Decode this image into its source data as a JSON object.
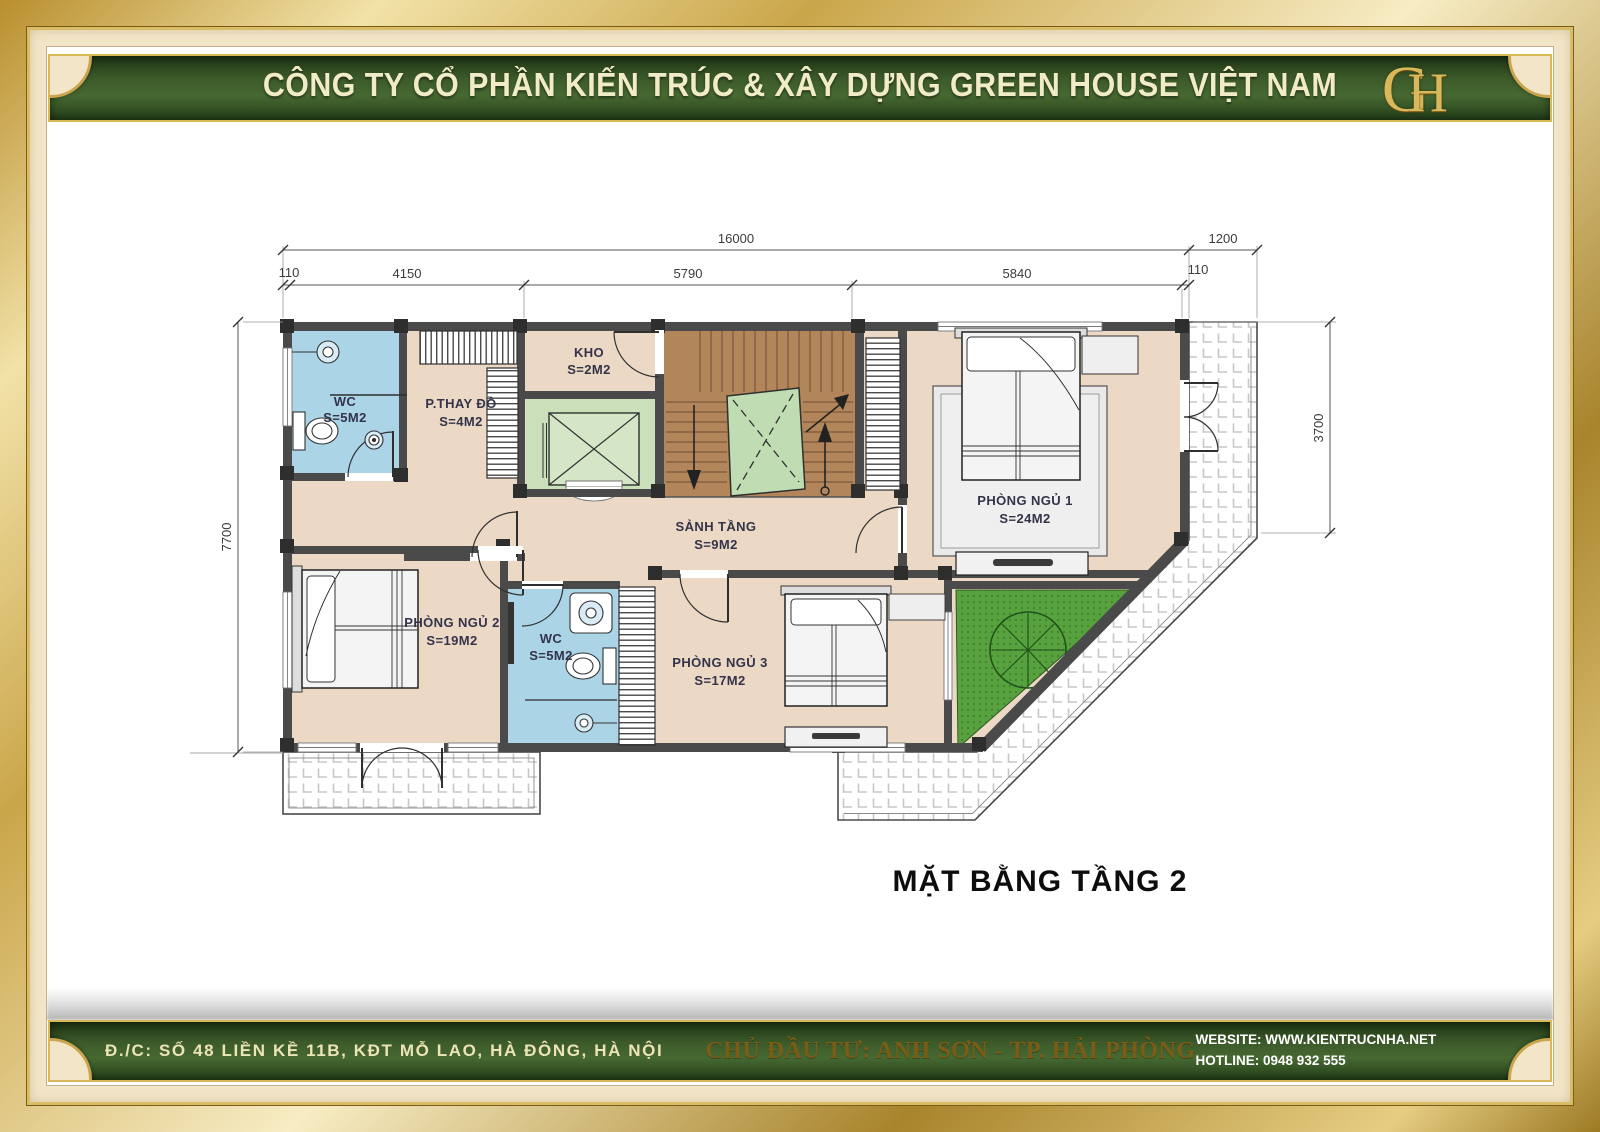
{
  "header": {
    "company": "CÔNG TY CỔ PHẦN KIẾN TRÚC & XÂY DỰNG GREEN HOUSE VIỆT NAM",
    "logo_g": "G",
    "logo_h": "H"
  },
  "plan": {
    "title": "MẶT BẰNG TẦNG 2",
    "rooms": [
      {
        "name": "WC",
        "area": "S=5M2"
      },
      {
        "name": "P.THAY ĐỒ",
        "area": "S=4M2"
      },
      {
        "name": "KHO",
        "area": "S=2M2"
      },
      {
        "name": "SẢNH TẦNG",
        "area": "S=9M2"
      },
      {
        "name": "PHÒNG NGỦ 1",
        "area": "S=24M2"
      },
      {
        "name": "PHÒNG NGỦ 2",
        "area": "S=19M2"
      },
      {
        "name": "WC",
        "area": "S=5M2"
      },
      {
        "name": "PHÒNG NGỦ 3",
        "area": "S=17M2"
      }
    ],
    "dims": {
      "total": "16000",
      "balcony": "1200",
      "seg_left_110": "110",
      "seg_4150": "4150",
      "seg_5790": "5790",
      "seg_5840": "5840",
      "seg_right_110": "110",
      "height_left": "7700",
      "height_right": "3700"
    }
  },
  "footer": {
    "address": "Đ./C: SỐ 48 LIỀN KỀ 11B, KĐT MỖ LAO, HÀ ĐÔNG, HÀ NỘI",
    "investor": "CHỦ ĐẦU TƯ: ANH SƠN - TP. HẢI PHÒNG",
    "website": "WEBSITE: WWW.KIENTRUCNHA.NET",
    "hotline": "HOTLINE: 0948 932 555"
  },
  "colors": {
    "frame_gold": "#d8b95c",
    "mat_cream": "#f3e6c8",
    "banner_green": "#3f5e2c",
    "banner_text": "#f1ecc7",
    "floor_tan": "#ecd9c5",
    "wet_blue": "#abd4e7",
    "stair_brown": "#b2855b",
    "lift_green": "#c9e0bb",
    "garden_green": "#57a13e"
  }
}
